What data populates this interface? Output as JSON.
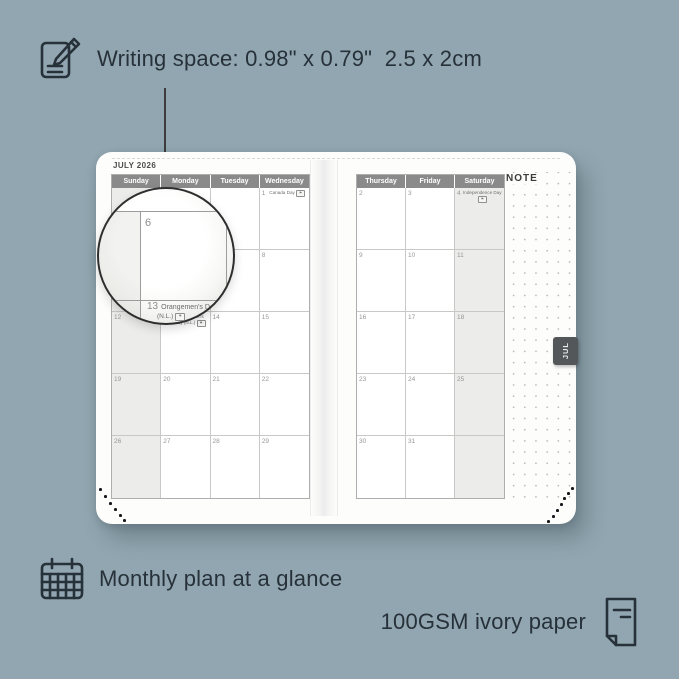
{
  "annotations": {
    "writing_space_label": "Writing space: 0.98\" x 0.79\"  2.5 x 2cm",
    "monthly_plan_label": "Monthly plan at a glance",
    "paper_label": "100GSM ivory paper"
  },
  "planner": {
    "month_title": "JULY 2026",
    "tab_label": "JUL",
    "note_label": "NOTE",
    "left_page": {
      "day_headers": [
        "Sunday",
        "Monday",
        "Tuesday",
        "Wednesday"
      ],
      "shaded_column": 0,
      "rows": [
        [
          {
            "date": ""
          },
          {
            "date": ""
          },
          {
            "date": ""
          },
          {
            "date": "1",
            "holiday": "Canada Day",
            "flag": true
          }
        ],
        [
          {
            "date": "5"
          },
          {
            "date": "6"
          },
          {
            "date": "7"
          },
          {
            "date": "8"
          }
        ],
        [
          {
            "date": "12"
          },
          {
            "date": "13",
            "holiday": "Orangemen's Day (N.L.)",
            "flag": true
          },
          {
            "date": "14"
          },
          {
            "date": "15"
          }
        ],
        [
          {
            "date": "19"
          },
          {
            "date": "20"
          },
          {
            "date": "21"
          },
          {
            "date": "22"
          }
        ],
        [
          {
            "date": "26"
          },
          {
            "date": "27"
          },
          {
            "date": "28"
          },
          {
            "date": "29"
          }
        ]
      ]
    },
    "right_page": {
      "day_headers": [
        "Thursday",
        "Friday",
        "Saturday"
      ],
      "shaded_column": 2,
      "rows": [
        [
          {
            "date": "2"
          },
          {
            "date": "3"
          },
          {
            "date": "4",
            "holiday": "Independence Day",
            "flag": true
          }
        ],
        [
          {
            "date": "9"
          },
          {
            "date": "10"
          },
          {
            "date": "11"
          }
        ],
        [
          {
            "date": "16"
          },
          {
            "date": "17"
          },
          {
            "date": "18"
          }
        ],
        [
          {
            "date": "23"
          },
          {
            "date": "24"
          },
          {
            "date": "25"
          }
        ],
        [
          {
            "date": "30"
          },
          {
            "date": "31"
          },
          {
            "date": ""
          }
        ]
      ]
    },
    "magnifier": {
      "zoom_date_left": "6",
      "zoom_date_right": "7",
      "zoom_date_13": "13",
      "zoom_holiday": "Orangemen's Day",
      "zoom_holiday_region": "(N.L.)"
    }
  },
  "colors": {
    "background": "#91a6b0",
    "page": "#fdfdfc",
    "day_header_bar": "#8a8a8a",
    "shaded_column": "#ececea",
    "annotation_text": "#27313a",
    "month_tab": "#53575a"
  }
}
